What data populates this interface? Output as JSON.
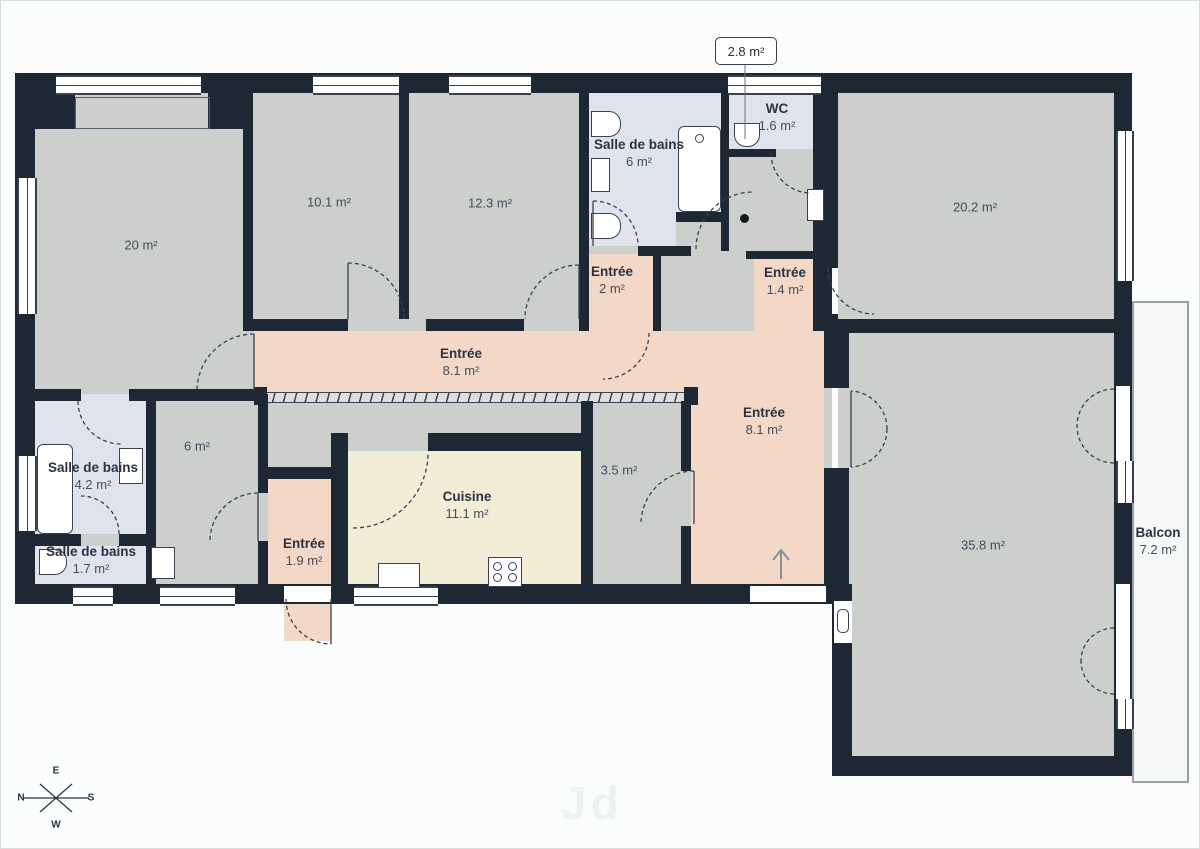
{
  "rooms": {
    "r20": {
      "name": "",
      "area": "20 m²"
    },
    "r101": {
      "name": "",
      "area": "10.1 m²"
    },
    "r123": {
      "name": "",
      "area": "12.3 m²"
    },
    "sdb6": {
      "name": "Salle de bains",
      "area": "6 m²"
    },
    "wc": {
      "name": "WC",
      "area": "1.6 m²"
    },
    "r202": {
      "name": "",
      "area": "20.2 m²"
    },
    "e2": {
      "name": "Entrée",
      "area": "2 m²"
    },
    "e14": {
      "name": "Entrée",
      "area": "1.4 m²"
    },
    "e81h": {
      "name": "Entrée",
      "area": "8.1 m²"
    },
    "e81v": {
      "name": "Entrée",
      "area": "8.1 m²"
    },
    "sdb42": {
      "name": "Salle de bains",
      "area": "4.2 m²"
    },
    "sdb17": {
      "name": "Salle de bains",
      "area": "1.7 m²"
    },
    "r6": {
      "name": "",
      "area": "6 m²"
    },
    "e19": {
      "name": "Entrée",
      "area": "1.9 m²"
    },
    "cuisine": {
      "name": "Cuisine",
      "area": "11.1 m²"
    },
    "r35": {
      "name": "",
      "area": "3.5 m²"
    },
    "r358": {
      "name": "",
      "area": "35.8 m²"
    },
    "balcon": {
      "name": "Balcon",
      "area": "7.2 m²"
    }
  },
  "badge": {
    "label": "2.8 m²"
  },
  "compass": {
    "top": "E",
    "left": "N",
    "right": "S",
    "bottom": "W"
  },
  "watermark": "Jd",
  "colors": {
    "wall": "#1e2734",
    "grey": "#cdcfcc",
    "peach": "#f4d8c7",
    "blue": "#dfe3ee",
    "cream": "#f2edd7",
    "balcony": "#f6f7f7",
    "bg": "#fbfcfc",
    "line": "#39404e"
  }
}
